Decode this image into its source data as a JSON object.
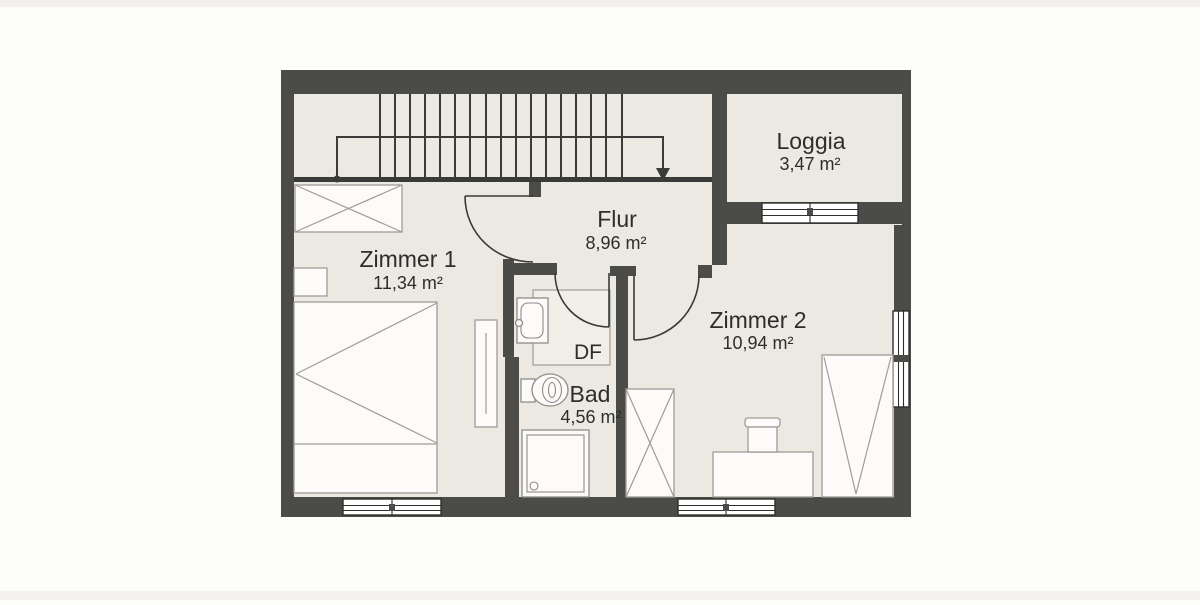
{
  "rooms": {
    "zimmer1": {
      "label": "Zimmer 1",
      "area": "11,34 m²"
    },
    "flur": {
      "label": "Flur",
      "area": "8,96 m²"
    },
    "loggia": {
      "label": "Loggia",
      "area": "3,47 m²"
    },
    "zimmer2": {
      "label": "Zimmer 2",
      "area": "10,94 m²"
    },
    "bad": {
      "label": "Bad",
      "area": "4,56 m²"
    },
    "df": {
      "label": "DF"
    }
  },
  "colors": {
    "wall": "#4b4b48",
    "floor": "#ece9e3",
    "df_skylight_fill": "#f1eee8",
    "furniture_fill": "#fcfbfa",
    "furniture_stroke": "#a09c95",
    "dark_line": "#3a3a38",
    "text": "#2d2d2b",
    "background": "#fdfdfc"
  },
  "icons": {
    "stairs": "stair-treads-with-walk-line-arrow",
    "furniture": [
      "wardrobe-icon",
      "double-bed-icon",
      "nightstand-icon",
      "shelf-icon",
      "washbasin-icon",
      "toilet-icon",
      "shower-icon",
      "desk-icon",
      "desk-chair-icon",
      "single-bed-icon",
      "window-icon",
      "door-swing-icon"
    ]
  }
}
